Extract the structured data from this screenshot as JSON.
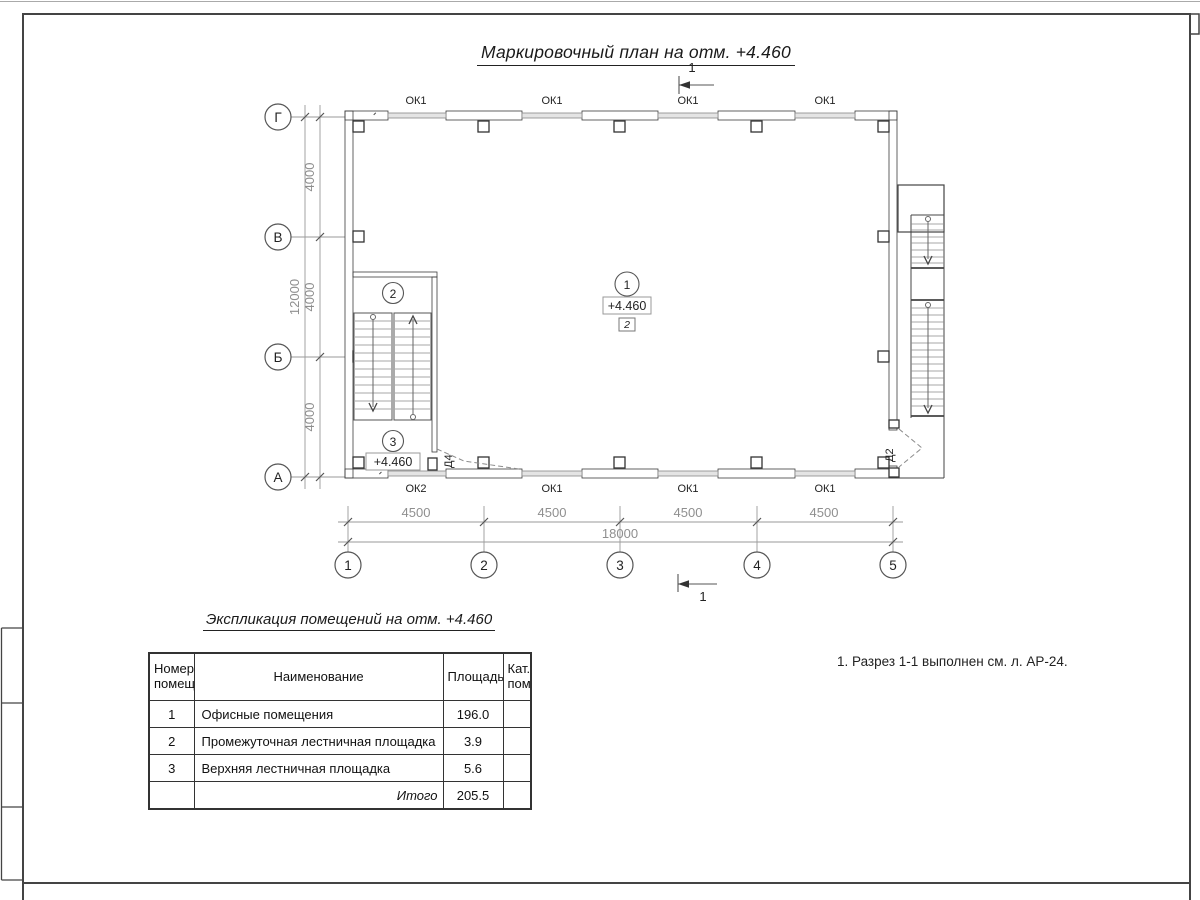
{
  "page": {
    "plan_title": "Маркировочный план на отм. +4.460",
    "note": "1. Разрез 1-1 выполнен см. л. АР-24."
  },
  "plan": {
    "section_label": "1",
    "axes_rows": [
      "Г",
      "В",
      "Б",
      "А"
    ],
    "axes_cols": [
      "1",
      "2",
      "3",
      "4",
      "5"
    ],
    "dims_vertical": [
      "4000",
      "4000",
      "4000"
    ],
    "dims_vertical_total": "12000",
    "dims_horizontal": [
      "4500",
      "4500",
      "4500",
      "4500"
    ],
    "dims_horizontal_total": "18000",
    "windows_top": [
      "ОК1",
      "ОК1",
      "ОК1",
      "ОК1"
    ],
    "windows_bottom": [
      "ОК2",
      "ОК1",
      "ОК1",
      "ОК1"
    ],
    "door_left": "Д4",
    "door_right": "Д2",
    "room1": {
      "num": "1",
      "elev": "+4.460",
      "finish": "2"
    },
    "room2": {
      "num": "2"
    },
    "room3": {
      "num": "3",
      "elev": "+4.460"
    }
  },
  "schedule": {
    "title": "Экспликация помещений на отм. +4.460",
    "headers": {
      "num": "Номер помещ.",
      "name": "Наименование",
      "area": "Площадь",
      "cat": "Кат. пом."
    },
    "rows": [
      {
        "num": "1",
        "name": "Офисные помещения",
        "area": "196.0",
        "cat": ""
      },
      {
        "num": "2",
        "name": "Промежуточная лестничная площадка",
        "area": "3.9",
        "cat": ""
      },
      {
        "num": "3",
        "name": "Верхняя лестничная площадка",
        "area": "5.6",
        "cat": ""
      }
    ],
    "total_label": "Итого",
    "total_area": "205.5"
  }
}
